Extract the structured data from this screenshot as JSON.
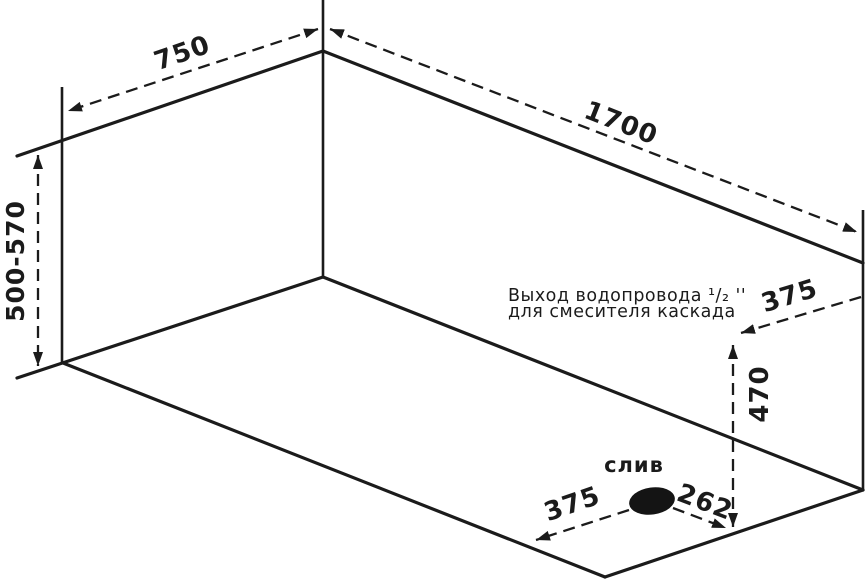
{
  "diagram": {
    "kind": "bathtub-installation-dimension-drawing",
    "background_color": "#ffffff",
    "ink_color": "#1b1b1b",
    "dimensions": {
      "top_width": "750",
      "top_length": "1700",
      "side_height": "500-570",
      "outlet_offset_from_edge": "375",
      "outlet_height": "470",
      "drain_offset_long_side": "375",
      "drain_offset_short_side": "262"
    },
    "annotations": {
      "drain_label": "слив",
      "outlet_note_line1": "Выход водопровода ¹/₂ ''",
      "outlet_note_line2": "для смесителя каскада"
    }
  }
}
